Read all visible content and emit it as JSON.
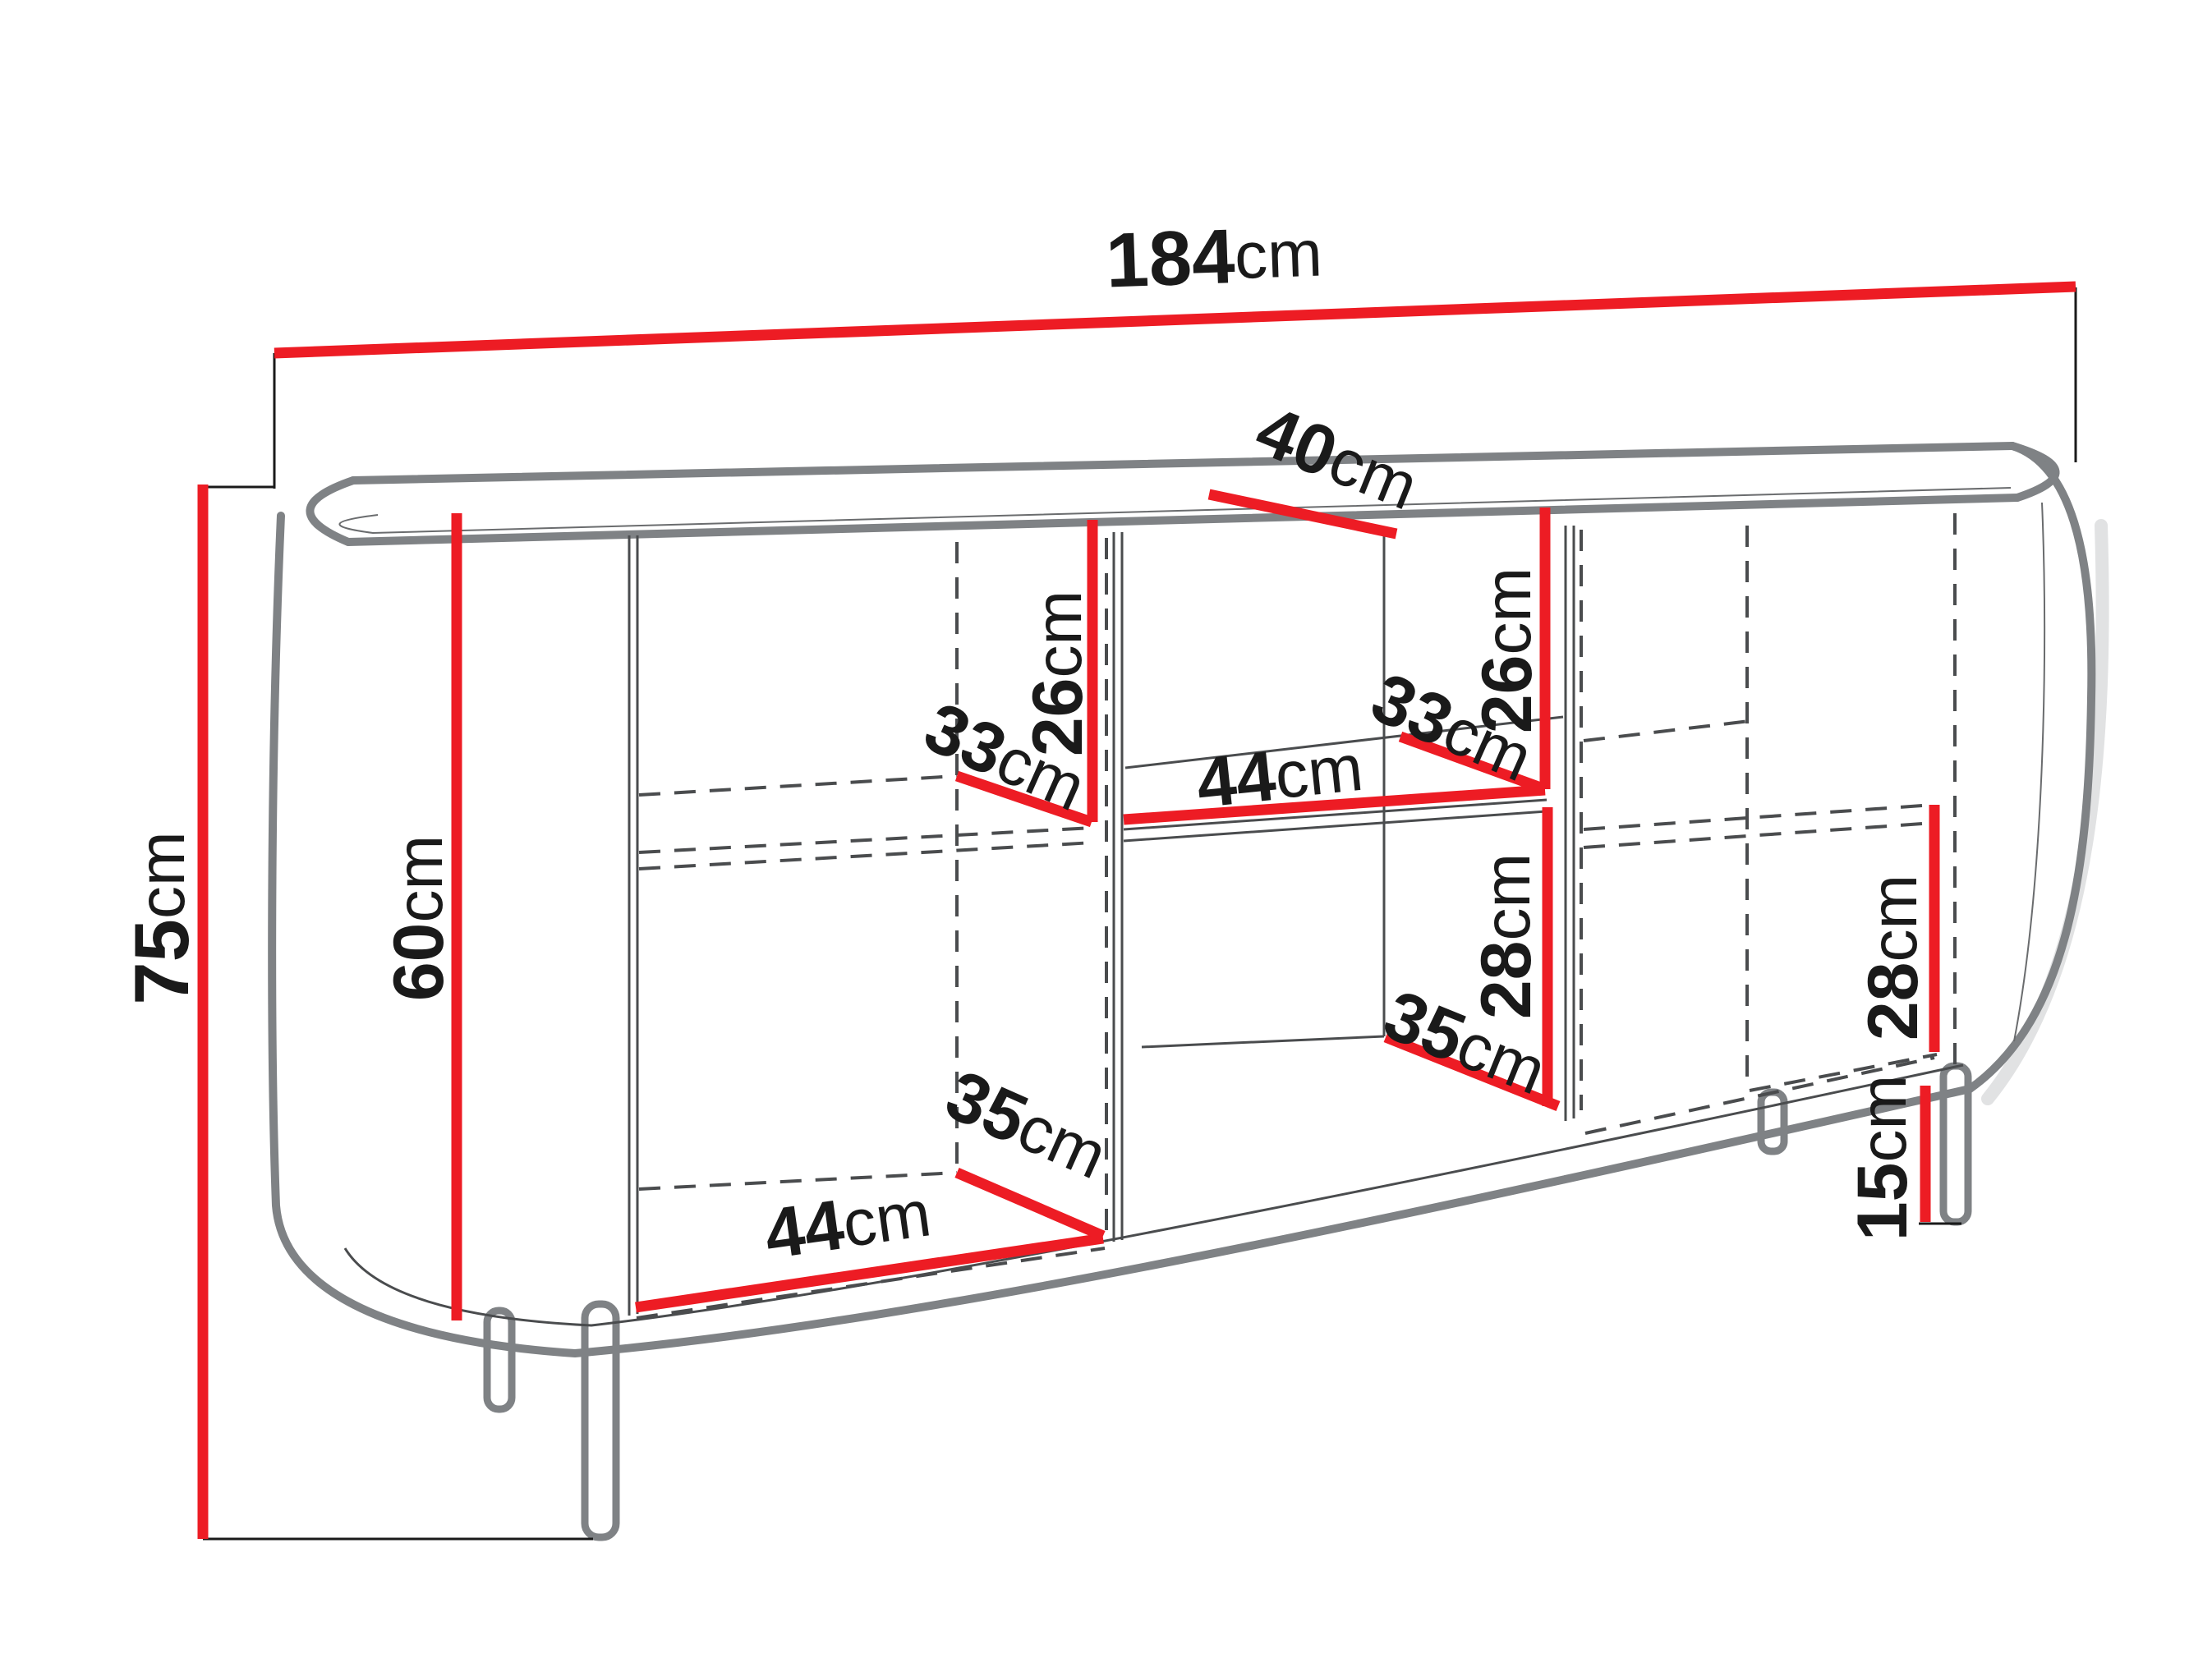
{
  "diagram": {
    "type": "furniture-dimension-diagram",
    "subject": "sideboard with rounded ends, open middle shelf section, two door sections and four legs",
    "unit": "cm",
    "colors": {
      "dimension_line": "#ed1c24",
      "furniture_outline": "#7f8285",
      "hidden_edge": "#4a4c4e",
      "label_text": "#1a1a1a",
      "background": "#ffffff"
    },
    "dimensions": {
      "width": {
        "value": "184",
        "unit": "cm"
      },
      "top_depth": {
        "value": "40",
        "unit": "cm"
      },
      "height": {
        "value": "75",
        "unit": "cm"
      },
      "body_height": {
        "value": "60",
        "unit": "cm"
      },
      "left_upper_height": {
        "value": "26",
        "unit": "cm"
      },
      "left_upper_depth": {
        "value": "33",
        "unit": "cm"
      },
      "mid_upper_height": {
        "value": "26",
        "unit": "cm"
      },
      "mid_upper_depth": {
        "value": "33",
        "unit": "cm"
      },
      "mid_shelf_width": {
        "value": "44",
        "unit": "cm"
      },
      "mid_lower_height": {
        "value": "28",
        "unit": "cm"
      },
      "mid_lower_depth": {
        "value": "35",
        "unit": "cm"
      },
      "left_lower_depth": {
        "value": "35",
        "unit": "cm"
      },
      "left_bottom_width": {
        "value": "44",
        "unit": "cm"
      },
      "right_lower_height": {
        "value": "28",
        "unit": "cm"
      },
      "leg_height": {
        "value": "15",
        "unit": "cm"
      }
    }
  }
}
